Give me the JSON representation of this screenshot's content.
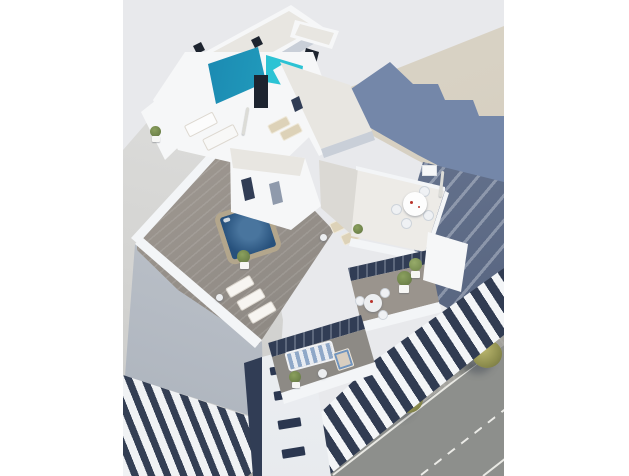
{
  "scene": {
    "kind": "architectural-3d-render",
    "view": "aerial three-quarter view of a modern white apartment building",
    "palette": {
      "canvas": "#ffffff",
      "sky": "#e8e9ec",
      "wall_light": "#d9d9d7",
      "ground_beige": "#d5cec0",
      "shadow_blue": "#7487a9",
      "slate_dark": "#5a6883",
      "street": "#8d8f8c",
      "sidewalk": "#a3a29d",
      "tree_olive": "#a4a15f",
      "building_white": "#f6f7f8",
      "gravel_roof": "#e8e6e1",
      "face_shade": "#c9cfd8",
      "pool_teal": "#2cc3d4",
      "pool_deep": "#1573a4",
      "pool_pillar": "#1d242f",
      "glass_dark": "#313d55",
      "deck_wood": "#968f88",
      "hot_tub_rim": "#b3a68c",
      "hot_tub_water": "#27517c",
      "lounger_beige": "#ddd2b8",
      "sofa_blue": "#8fa8c8",
      "plant_green": "#6d8149",
      "accent_red": "#b8322a"
    },
    "objects": [
      "rooftop pool (two-tone turquoise) with dark dividing pillar",
      "top roof slab with gravel surface and stair windows",
      "rooftop terrace with white outdoor sofa, parasol and beige sun loungers",
      "penthouse volumes with dark glass doors and gravel roofs",
      "upper dining terrace with round white table, four chairs, parasol and planters",
      "large wood-plank deck with hot tub, sun loungers and potted plants",
      "mid-level balcony with bistro table, chairs and green bushes",
      "lower balcony with blue striped sofa, deck chair, side table and plant",
      "white entrance pillar with stacked dark windows",
      "front facade with alternating white balcony bands and dark glazing",
      "neighboring building wall (left) and striped balconies (bottom left)",
      "beige plaza with stepped blue building shadow (top right)",
      "shadowed side street (right)",
      "asphalt street with solid and dashed white lane markings",
      "sidewalk with three olive street trees and tree shadows"
    ]
  }
}
